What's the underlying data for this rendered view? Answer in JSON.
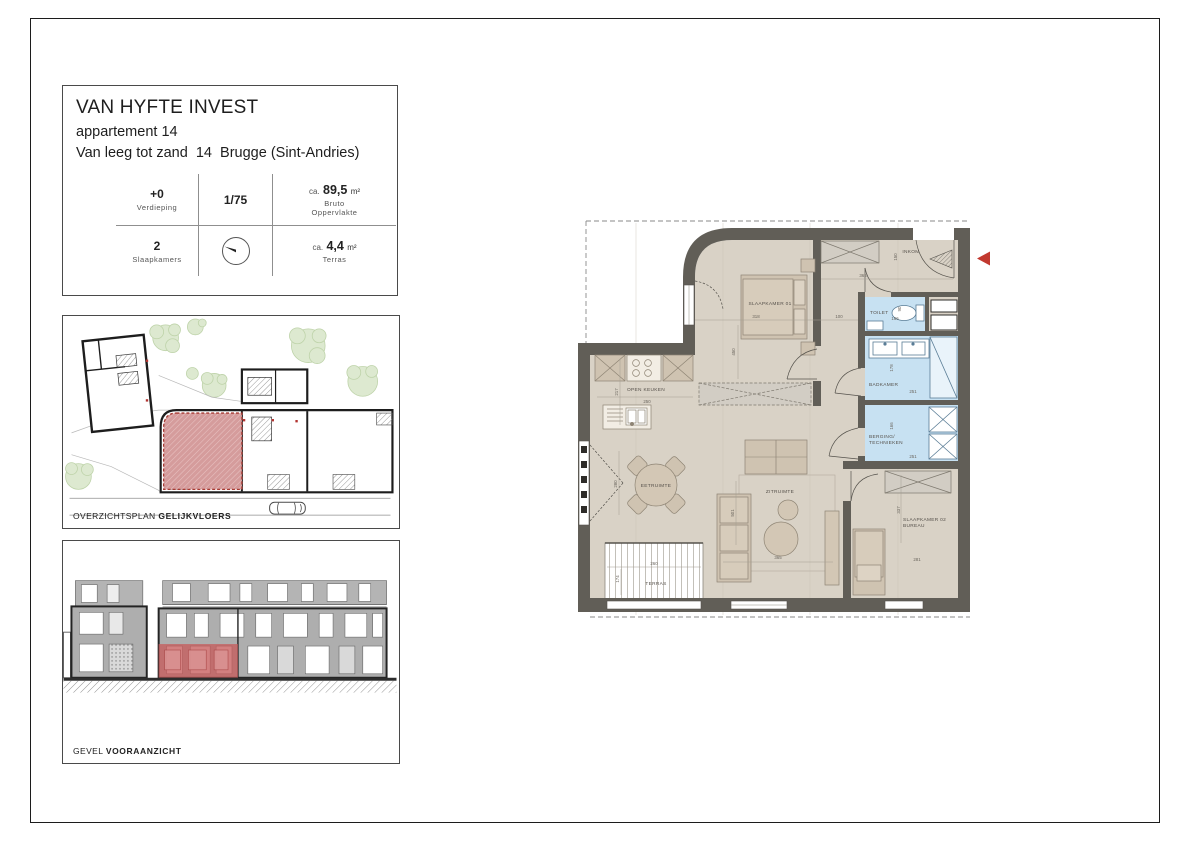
{
  "title_block": {
    "company": "VAN HYFTE INVEST",
    "apartment": "appartement 14",
    "address": "Van leeg tot zand  14  Brugge (Sint-Andries)",
    "floor_value": "+0",
    "floor_label": "Verdieping",
    "scale": "1/75",
    "area_prefix": "ca.",
    "gross_area_value": "89,5",
    "gross_area_unit": "m²",
    "gross_area_label_1": "Bruto",
    "gross_area_label_2": "Oppervlakte",
    "bedrooms_value": "2",
    "bedrooms_label": "Slaapkamers",
    "terrace_value": "4,4",
    "terrace_unit": "m²",
    "terrace_label": "Terras"
  },
  "site_plan": {
    "caption": "OVERZICHTSPLAN",
    "caption_bold": "GELIJKVLOERS"
  },
  "elevation": {
    "caption": "GEVEL",
    "caption_bold": "VOORAANZICHT"
  },
  "floor_plan": {
    "inkom": {
      "label": "INKOM",
      "dim_width": "365",
      "dim_depth": "150",
      "dim_corridor": "100"
    },
    "slaapkamer_01": {
      "label": "SLAAPKAMER 01",
      "dim_width": "318",
      "dim_depth": "450"
    },
    "toilet": {
      "label": "TOILET",
      "dim_width": "166",
      "dim_depth": "90"
    },
    "badkamer": {
      "label": "BADKAMER",
      "dim_width": "251",
      "dim_depth": "178"
    },
    "berging": {
      "label_line1": "BERGING/",
      "label_line2": "TECHNIEKEN",
      "dim_width": "251",
      "dim_depth": "166"
    },
    "slaapkamer_02": {
      "label_line1": "SLAAPKAMER 02",
      "label_line2": "BUREAU",
      "dim_width": "281",
      "dim_depth": "337"
    },
    "open_keuken": {
      "label": "OPEN KEUKEN",
      "dim_width": "250",
      "dim_depth": "217"
    },
    "eetruimte": {
      "label": "EETRUIMTE",
      "dim_depth": "280"
    },
    "zitruimte": {
      "label": "ZITRUIMTE",
      "dim_width": "365",
      "dim_depth": "501"
    },
    "terras": {
      "label": "TERRAS",
      "dim_width": "260",
      "dim_depth": "174"
    }
  },
  "colors": {
    "wall": "#615e57",
    "floor": "#d9d2c6",
    "wet_room": "#c7e1f2",
    "highlight_red": "#c2392f"
  }
}
